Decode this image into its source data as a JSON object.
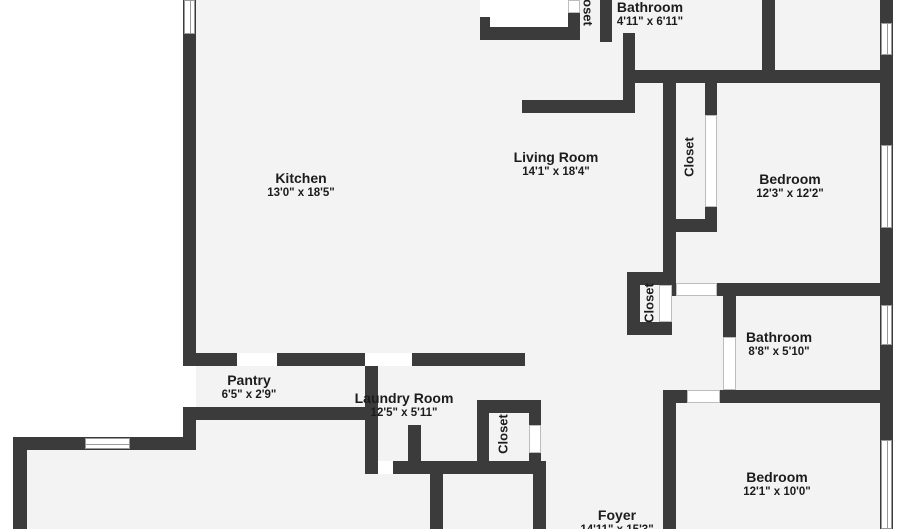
{
  "floorplan": {
    "rooms": {
      "kitchen": {
        "name": "Kitchen",
        "dims": "13'0\" x 18'5\""
      },
      "living_room": {
        "name": "Living Room",
        "dims": "14'1\" x 18'4\""
      },
      "bathroom_top": {
        "name": "Bathroom",
        "dims": "4'11\" x 6'11\""
      },
      "bedroom_right": {
        "name": "Bedroom",
        "dims": "12'3\" x 12'2\""
      },
      "bathroom_right": {
        "name": "Bathroom",
        "dims": "8'8\" x 5'10\""
      },
      "bedroom_bottom": {
        "name": "Bedroom",
        "dims": "12'1\" x 10'0\""
      },
      "pantry": {
        "name": "Pantry",
        "dims": "6'5\" x 2'9\""
      },
      "laundry": {
        "name": "Laundry Room",
        "dims": "12'5\" x 5'11\""
      },
      "foyer": {
        "name": "Foyer",
        "dims": "14'11\" x 15'3\""
      },
      "closet_top": {
        "name": "Closet"
      },
      "closet_bedroom": {
        "name": "Closet"
      },
      "closet_hall": {
        "name": "Closet"
      },
      "closet_laundry": {
        "name": "Closet"
      }
    },
    "colors": {
      "wall": "#3b3b3b",
      "interior": "#f3f3f3",
      "exterior": "#ffffff",
      "text": "#1c1c1c"
    }
  }
}
